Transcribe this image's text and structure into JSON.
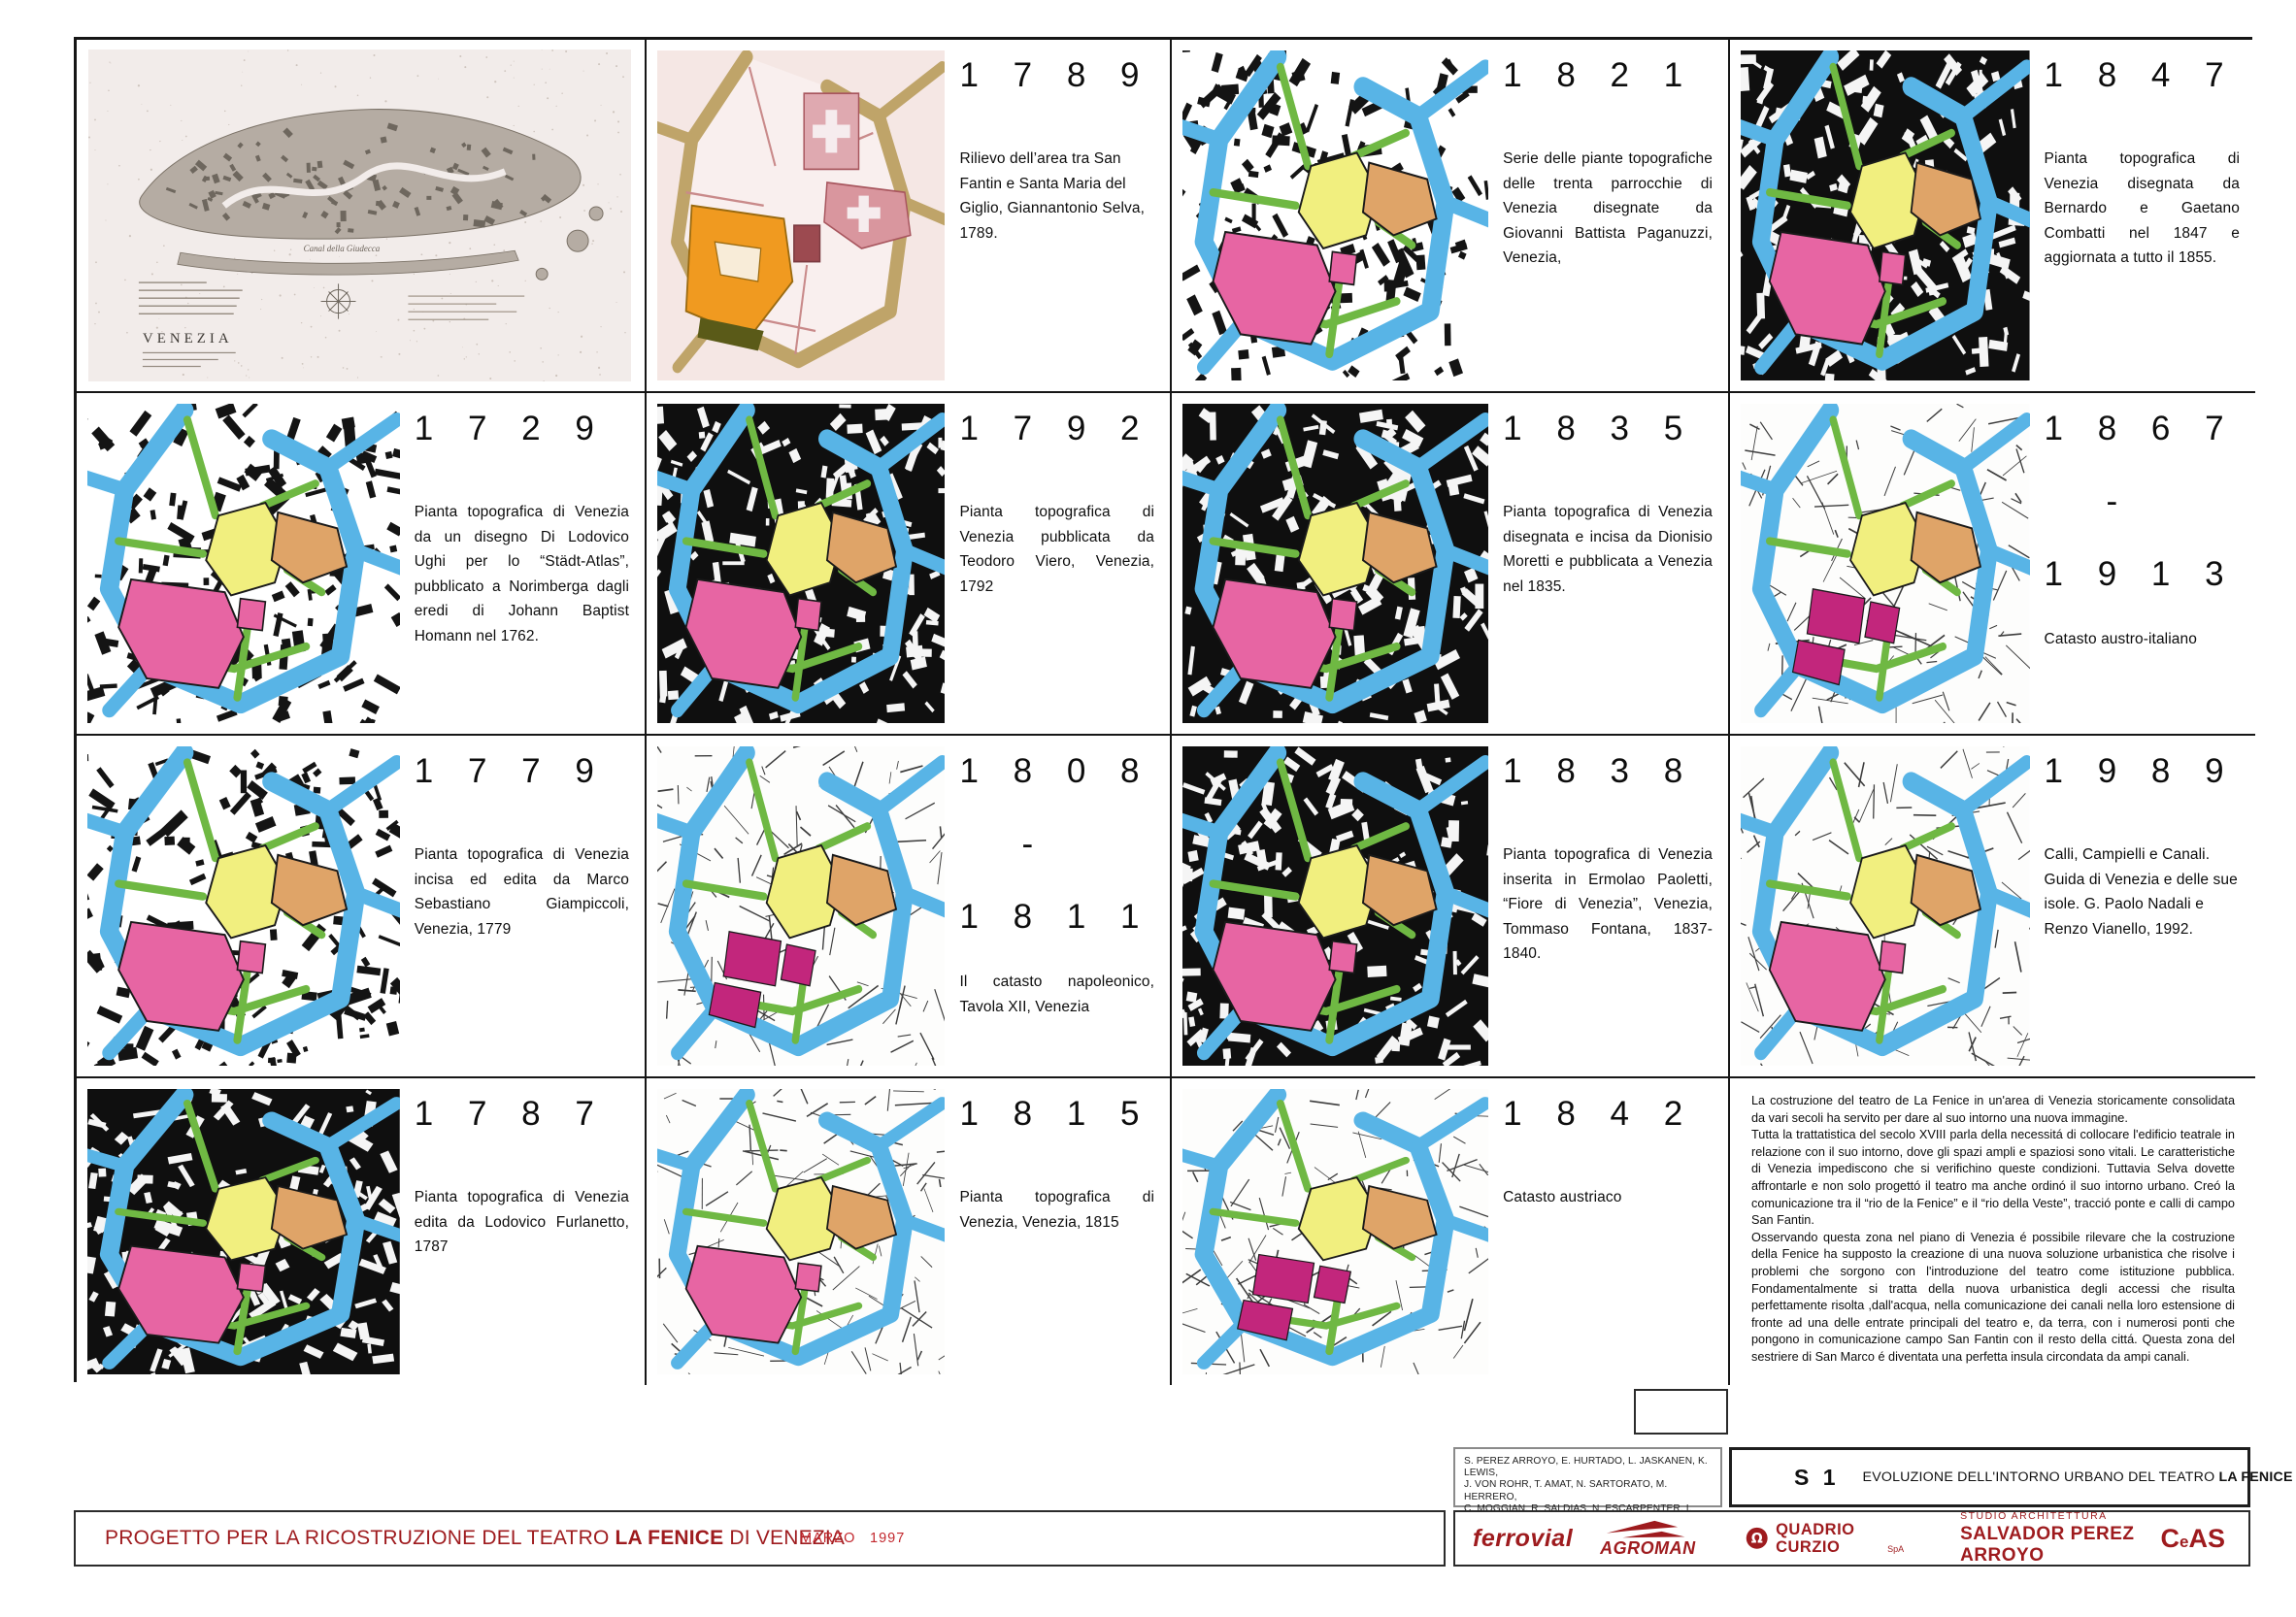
{
  "colors": {
    "border": "#161616",
    "canal_blue": "#58b4e6",
    "street_green": "#6fb843",
    "campo_yellow": "#f1ef7f",
    "theatre_orange": "#dfa468",
    "building_pink": "#e765a3",
    "building_magenta": "#c2267c",
    "accent_dark_red": "#9e1b1e",
    "accent_red": "#c2272d",
    "parchment_bg": "#f5e7e4",
    "parchment_street": "#bfa469",
    "parchment_orange": "#f09a20"
  },
  "overview": {
    "title_label": "VENEZIA",
    "canal_label": "Canal della Giudecca"
  },
  "grid": [
    {
      "type": "overview"
    },
    {
      "type": "panel",
      "id": "1789",
      "year_lines": [
        "1 7 8 9"
      ],
      "caption": "Rilievo dell’area tra San Fantin e Santa Maria del Giglio, Giannantonio Selva, 1789.",
      "map_style": "parchment"
    },
    {
      "type": "panel",
      "id": "1821",
      "year_lines": [
        "1 8 2 1"
      ],
      "caption": "Serie delle piante topografiche delle trenta parrocchie di Venezia disegnate da Giovanni Battista Paganuzzi, Venezia,",
      "map_style": "scribble-white"
    },
    {
      "type": "panel",
      "id": "1847",
      "year_lines": [
        "1 8 4 7"
      ],
      "caption": "Pianta topografica di Venezia disegnata da Bernardo e Gaetano Combatti nel 1847 e aggiornata a tutto il 1855.",
      "map_style": "scribble-black"
    },
    {
      "type": "panel",
      "id": "1729",
      "year_lines": [
        "1 7 2 9"
      ],
      "caption": "Pianta topografica di Venezia da un disegno Di Lodovico Ughi per lo “Städt-Atlas”, pubblicato a Norimberga dagli eredi di Johann Baptist Homann nel 1762.",
      "map_style": "scribble-white"
    },
    {
      "type": "panel",
      "id": "1792",
      "year_lines": [
        "1 7 9 2"
      ],
      "caption": "Pianta topografica di Venezia pubblicata da Teodoro Viero, Venezia, 1792",
      "map_style": "scribble-black"
    },
    {
      "type": "panel",
      "id": "1835",
      "year_lines": [
        "1 8 3 5"
      ],
      "caption": "Pianta topografica di Venezia disegnata e incisa da Dionisio Moretti e pubblicata a Venezia nel 1835.",
      "map_style": "scribble-black"
    },
    {
      "type": "panel",
      "id": "1867-1913",
      "year_lines": [
        "1 8 6 7",
        "-",
        "1 9 1 3"
      ],
      "caption": "Catasto austro-italiano",
      "map_style": "etched-magenta"
    },
    {
      "type": "panel",
      "id": "1779",
      "year_lines": [
        "1 7 7 9"
      ],
      "caption": "Pianta topografica di Venezia incisa ed edita da Marco Sebastiano Giampiccoli, Venezia, 1779",
      "map_style": "scribble-white"
    },
    {
      "type": "panel",
      "id": "1808-1811",
      "year_lines": [
        "1 8 0 8",
        "-",
        "1 8 1 1"
      ],
      "caption": "Il catasto napoleonico, Tavola XII, Venezia",
      "map_style": "etched-magenta"
    },
    {
      "type": "panel",
      "id": "1838",
      "year_lines": [
        "1 8 3 8"
      ],
      "caption": "Pianta topografica di Venezia inserita in Ermolao Paoletti, “Fiore di Venezia”, Venezia, Tommaso Fontana, 1837-1840.",
      "map_style": "scribble-black"
    },
    {
      "type": "panel",
      "id": "1989",
      "year_lines": [
        "1 9 8 9"
      ],
      "caption": "Calli, Campielli e Canali. Guida di Venezia e delle sue isole. G. Paolo Nadali e Renzo Vianello, 1992.",
      "map_style": "etched-pink"
    },
    {
      "type": "panel",
      "id": "1787",
      "year_lines": [
        "1 7 8 7"
      ],
      "caption": "Pianta topografica di Venezia edita da Lodovico Furlanetto, 1787",
      "map_style": "scribble-black"
    },
    {
      "type": "panel",
      "id": "1815",
      "year_lines": [
        "1 8 1 5"
      ],
      "caption": "Pianta topografica di Venezia, Venezia, 1815",
      "map_style": "etched-pink"
    },
    {
      "type": "panel",
      "id": "1842",
      "year_lines": [
        "1 8 4 2"
      ],
      "caption": "Catasto austriaco",
      "map_style": "etched-magenta"
    },
    {
      "type": "essay"
    }
  ],
  "essay": {
    "paragraphs": [
      "La costruzione del teatro de La Fenice in un'area di Venezia storicamente consolidata da vari secoli ha servito per dare al suo intorno una nuova immagine.",
      "Tutta la trattatistica del secolo XVIII parla della necessitá di collocare l'edificio teatrale in relazione con il suo intorno, dove gli spazi ampli e spaziosi sono vitali. Le caratteristiche di Venezia impediscono che si verifichino queste condizioni. Tuttavia Selva dovette affrontarle e non solo progettó il teatro ma anche ordinó il suo intorno urbano. Creó la comunicazione tra il “rio de la Fenice” e il “rio della Veste”, tracció ponte e calli di campo San Fantin.",
      "Osservando questa zona nel piano di Venezia é possibile rilevare che la costruzione della Fenice ha supposto la creazione di una nuova soluzione urbanistica che risolve i problemi che sorgono con l'introduzione del teatro come istituzione pubblica. Fondamentalmente si tratta della nuova urbanistica degli accessi che risulta perfettamente risolta ,dall'acqua, nella comunicazione dei canali nella loro estensione di fronte ad una delle entrate principali del teatro e, da terra, con i numerosi ponti che pongono in comunicazione campo San Fantin con il resto della cittá. Questa zona del sestriere di San Marco é diventata una perfetta insula circondata da ampi canali."
    ]
  },
  "footer": {
    "credits_lines": [
      "S. PEREZ ARROYO, E. HURTADO, L. JASKANEN, K. LEWIS,",
      "J. VON ROHR, T. AMAT, N. SARTORATO, M. HERRERO,",
      "C. MOGGIAN,  R. SALDIAS, N. ESCARPENTER, I. PAJARES,",
      "A. FERNANDEZ, M. OLAVE, F. OLAVE, R. HEREDERO, I. MATEOS."
    ],
    "sheet": {
      "code": "S 1",
      "title_prefix": "EVOLUZIONE DELL'INTORNO URBANO DEL TEATRO ",
      "title_bold": "LA FENICE"
    },
    "project": {
      "prefix": "PROGETTO PER LA RICOSTRUZIONE DEL TEATRO ",
      "bold": "LA FENICE",
      "suffix": " DI VENEZIA",
      "month": "MARZO",
      "year": "1997"
    },
    "logos": {
      "ferrovial": "ferrovial",
      "agroman": "AGROMAN",
      "quadrio": "QUADRIO CURZIO",
      "quadrio_suffix": "SpA",
      "studio_line1": "STUDIO  ARCHITETTURA",
      "studio_line2": "SALVADOR PEREZ ARROYO",
      "ceas_c": "C",
      "ceas_e": "e",
      "ceas_as": "AS"
    }
  }
}
